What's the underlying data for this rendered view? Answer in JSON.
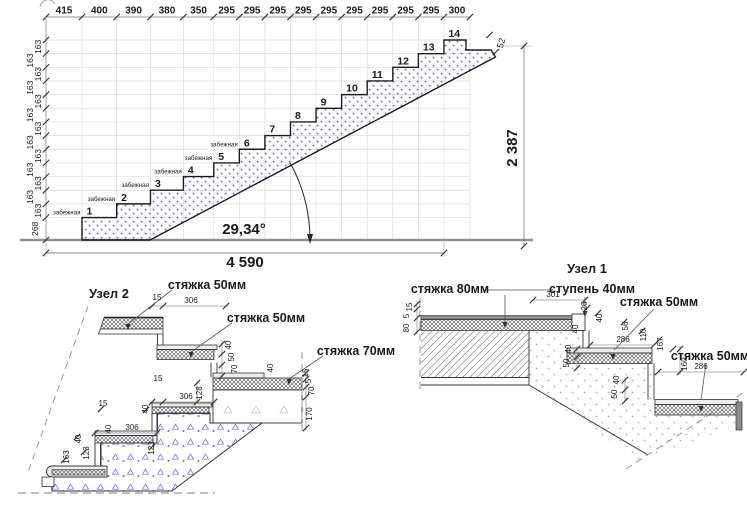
{
  "main": {
    "top_dims": [
      415,
      400,
      390,
      380,
      350,
      295,
      295,
      295,
      295,
      295,
      295,
      295,
      295,
      295,
      300
    ],
    "riser_first_mm": 268,
    "riser_mm": 163,
    "left_dim_label": "163",
    "first_riser_label": "268",
    "total_run": "4 590",
    "total_rise": "2 387",
    "edge_dim": "52",
    "angle": "29,34°",
    "step_numbers": [
      "1",
      "2",
      "3",
      "4",
      "5",
      "6",
      "7",
      "8",
      "9",
      "10",
      "11",
      "12",
      "13",
      "14"
    ],
    "winder_label": "забежная",
    "winder_steps": [
      1,
      2,
      3,
      4,
      5,
      6
    ]
  },
  "node2": {
    "title": "Узел 2",
    "labels": [
      "стяжка 50мм",
      "стяжка 50мм",
      "стяжка 70мм"
    ],
    "dims": [
      "15",
      "306",
      "40",
      "50",
      "70",
      "40",
      "15",
      "5",
      "70",
      "170",
      "15",
      "306",
      "128",
      "40",
      "306",
      "123",
      "40",
      "15",
      "163",
      "123",
      "40"
    ]
  },
  "node1": {
    "title": "Узел 1",
    "labels": [
      "стяжка 80мм",
      "ступень 40мм",
      "стяжка 50мм",
      "стяжка 50мм"
    ],
    "dims": [
      "15",
      "5",
      "80",
      "301",
      "26",
      "40",
      "40",
      "56",
      "110",
      "167",
      "286",
      "40",
      "50",
      "160",
      "286",
      "40",
      "50"
    ]
  },
  "colors": {
    "concrete_dot": "#4d4dcf",
    "grid": "#dcdcdc",
    "dim_line": "#999999",
    "outline": "#1c1c1c",
    "ground": "#909090"
  }
}
